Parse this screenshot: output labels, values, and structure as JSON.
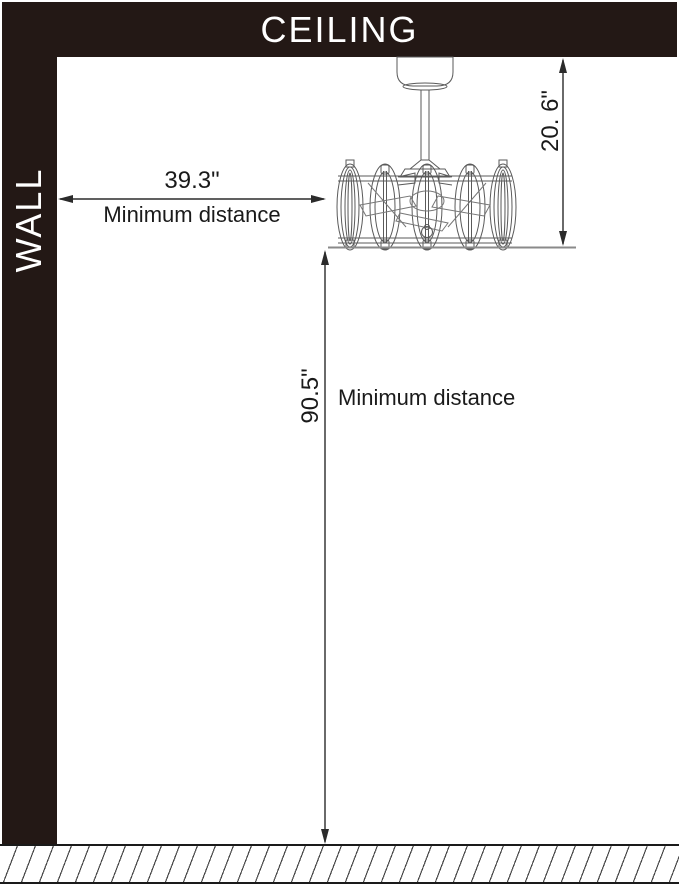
{
  "structure": {
    "ceiling_label": "CEILING",
    "wall_label": "WALL",
    "floor": "hatched-floor"
  },
  "dimensions": {
    "wall_to_fixture": {
      "value": "39.3\"",
      "label": "Minimum distance",
      "orientation": "horizontal"
    },
    "ceiling_to_fixture_bottom": {
      "value": "20. 6\"",
      "orientation": "vertical"
    },
    "fixture_bottom_to_floor": {
      "value": "90.5\"",
      "label": "Minimum distance",
      "orientation": "vertical"
    }
  },
  "fixture": {
    "icon": "caged-ceiling-fan-drawing"
  },
  "colors": {
    "structure_fill": "#231815",
    "label_light": "#ffffff",
    "text_dark": "#1a1a1a",
    "dimension_line": "#2b2b2b",
    "drawing_line": "#5a5a5a",
    "reference_line": "#8a8a8a"
  }
}
